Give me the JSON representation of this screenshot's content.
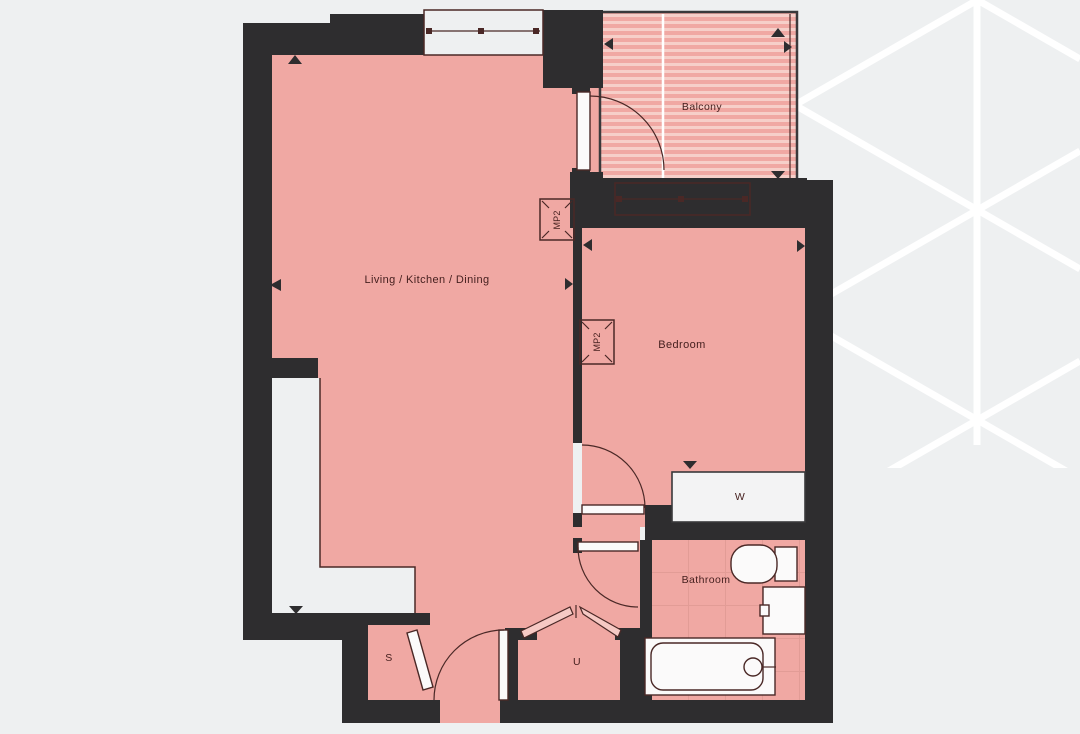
{
  "rooms": {
    "living": "Living / Kitchen / Dining",
    "bedroom": "Bedroom",
    "balcony": "Balcony",
    "bathroom": "Bathroom",
    "wardrobe": "W",
    "storage": "S",
    "utility": "U"
  },
  "markers": {
    "mp2_living": "MP2",
    "mp2_bedroom": "MP2"
  },
  "colors": {
    "background": "#eef0f1",
    "wall": "#2e2d2f",
    "room-fill": "#f0a8a3",
    "room-line": "#4a2826",
    "stripe": "#f6cfc9",
    "tile-line": "#e29c96",
    "fixture": "#fbfafa",
    "pattern-line": "#ffffff",
    "label": "#46201f"
  }
}
